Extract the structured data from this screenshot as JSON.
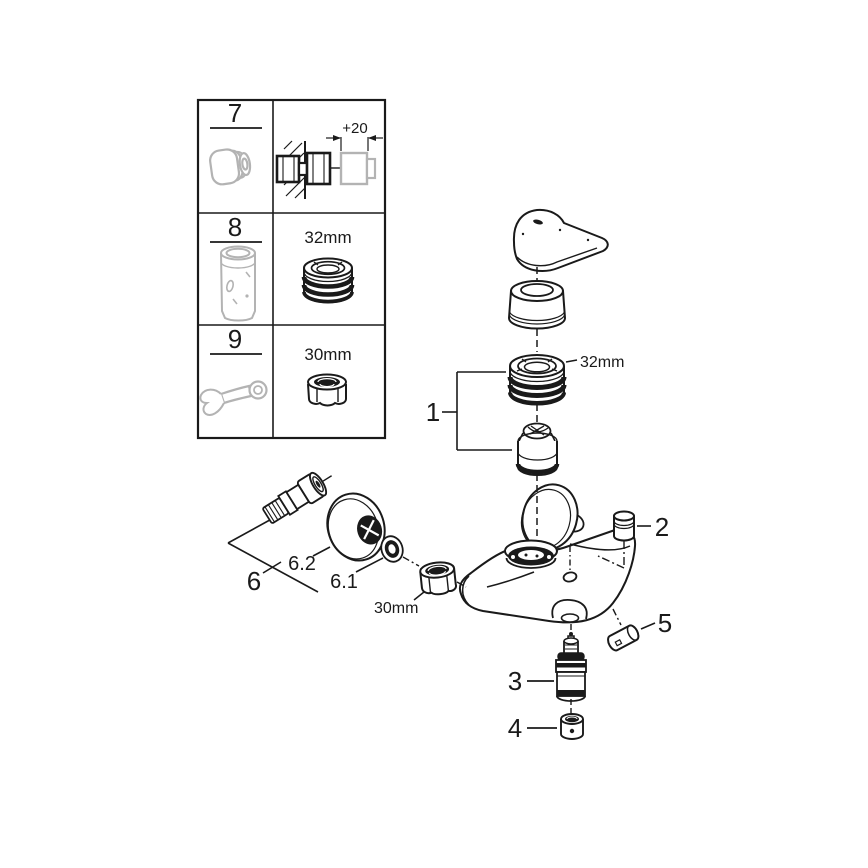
{
  "colors": {
    "line": "#1a1a1a",
    "tool_gray": "#b3b3b3",
    "background": "#ffffff"
  },
  "tools_table": {
    "rows": [
      {
        "num": "7",
        "tool": "extension-nipple",
        "note": "+20"
      },
      {
        "num": "8",
        "tool": "cartridge-socket",
        "size": "32mm"
      },
      {
        "num": "9",
        "tool": "open-end-wrench",
        "size": "30mm"
      }
    ]
  },
  "exploded_view": {
    "callouts": {
      "1": "1",
      "2": "2",
      "3": "3",
      "4": "4",
      "5": "5",
      "6": "6",
      "6_1": "6.1",
      "6_2": "6.2"
    },
    "ring_nut_size": "32mm",
    "union_nut_size": "30mm"
  }
}
